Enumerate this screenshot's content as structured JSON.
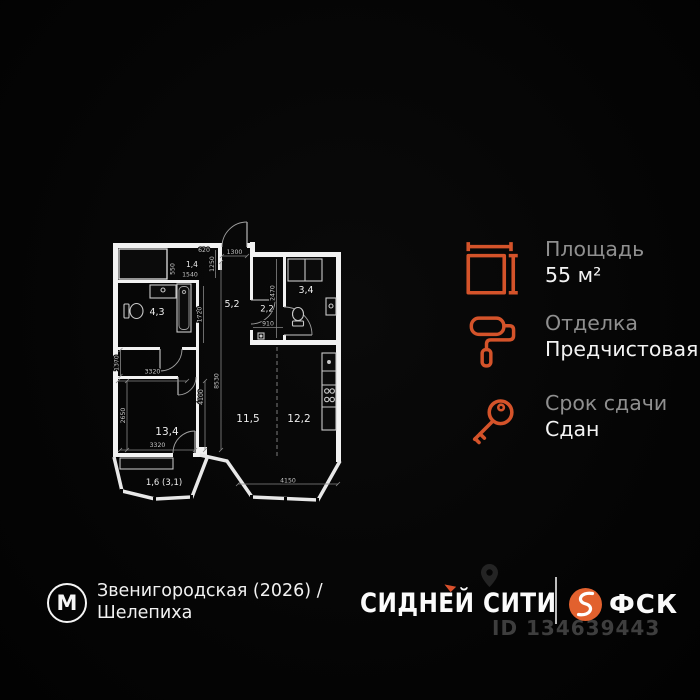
{
  "colors": {
    "accent": "#d4532a",
    "fsk_orange": "#e2612e",
    "background": "#050505",
    "wall_white": "#f2f2f2",
    "label_gray": "#8f8f8f",
    "value_white": "#f3f3f3"
  },
  "plan": {
    "rooms": {
      "r14": "1,4",
      "r43": "4,3",
      "r52": "5,2",
      "r22": "2,2",
      "r34": "3,4",
      "r134": "13,4",
      "r115": "11,5",
      "r122": "12,2",
      "balcony": "1,6 (3,1)"
    },
    "dims": {
      "top_620": "620",
      "entry_1300": "1300",
      "right_1250": "1250",
      "closet_1540": "1540",
      "closet_550": "550",
      "bath_1720": "1720",
      "wc_2470": "2470",
      "wc_910": "910",
      "hall_1370": "1370",
      "bed_3320_top": "3320",
      "bed_2650": "2650",
      "bed_4100": "4100",
      "corr_8530": "8530",
      "bed_3320_bottom": "3320",
      "kitchen_4150": "4150"
    }
  },
  "info": {
    "items": [
      {
        "icon": "area-icon",
        "label": "Площадь",
        "value": "55 м²"
      },
      {
        "icon": "paint-roller-icon",
        "label": "Отделка",
        "value": "Предчистовая"
      },
      {
        "icon": "key-icon",
        "label": "Срок сдачи",
        "value": "Сдан"
      }
    ]
  },
  "footer": {
    "metro_letter": "М",
    "location_line1": "Звенигородская (2026) /",
    "location_line2": "Шелепиха",
    "brand": "СИДНЕЙ СИТИ",
    "developer_name": "ФСК",
    "listing_id": "ID 134639443"
  }
}
